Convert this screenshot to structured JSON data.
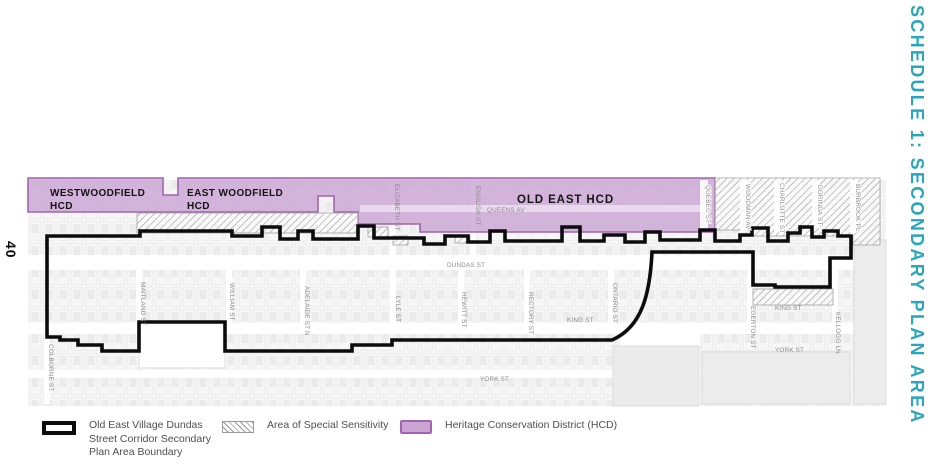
{
  "page": {
    "number": "40",
    "schedule_title": "SCHEDULE 1: SECONDARY PLAN AREA"
  },
  "districts": {
    "westwoodfield": {
      "line1": "WESTWOODFIELD",
      "line2": "HCD"
    },
    "east_woodfield": {
      "line1": "EAST WOODFIELD",
      "line2": "HCD"
    },
    "old_east": {
      "label": "OLD EAST HCD"
    }
  },
  "streets": {
    "queens_av": "QUEENS AV",
    "dundas_st": "DUNDAS ST",
    "king_st_mid": "KING ST",
    "king_st_east": "KING ST",
    "york_st_mid": "YORK ST",
    "york_st_east": "YORK ST",
    "colborne_st": "COLBORNE ST",
    "maitland_st": "MAITLAND ST",
    "william_st": "WILLIAM ST",
    "adelaide_st_n": "ADELAIDE ST N",
    "elizabeth_st": "ELIZABETH ST",
    "english_st": "ENGLISH ST",
    "lyle_st": "LYLE ST",
    "hewitt_st": "HEWITT ST",
    "rectory_st": "RECTORY ST",
    "ontario_st": "ONTARIO ST",
    "quebec_st": "QUEBEC ST",
    "woodman_av": "WOODMAN AV",
    "charlotte_st": "CHARLOTTE ST",
    "dorinda_st": "DORINDA ST",
    "burbrook_pl": "BURBROOK PL",
    "egerton_st": "EGERTON ST",
    "kellogg_ln": "KELLOGG LN"
  },
  "legend": {
    "boundary_label": "Old East Village Dundas Street Corridor Secondary Plan Area Boundary",
    "sensitivity_label": "Area of Special Sensitivity",
    "hcd_label": "Heritage Conservation District (HCD)"
  },
  "colors": {
    "accent_teal": "#2AA6BC",
    "hcd_fill": "#CBA5D4",
    "hcd_border": "#A264AE",
    "boundary_black": "#0C0C0C",
    "hatch_line": "#979797"
  }
}
